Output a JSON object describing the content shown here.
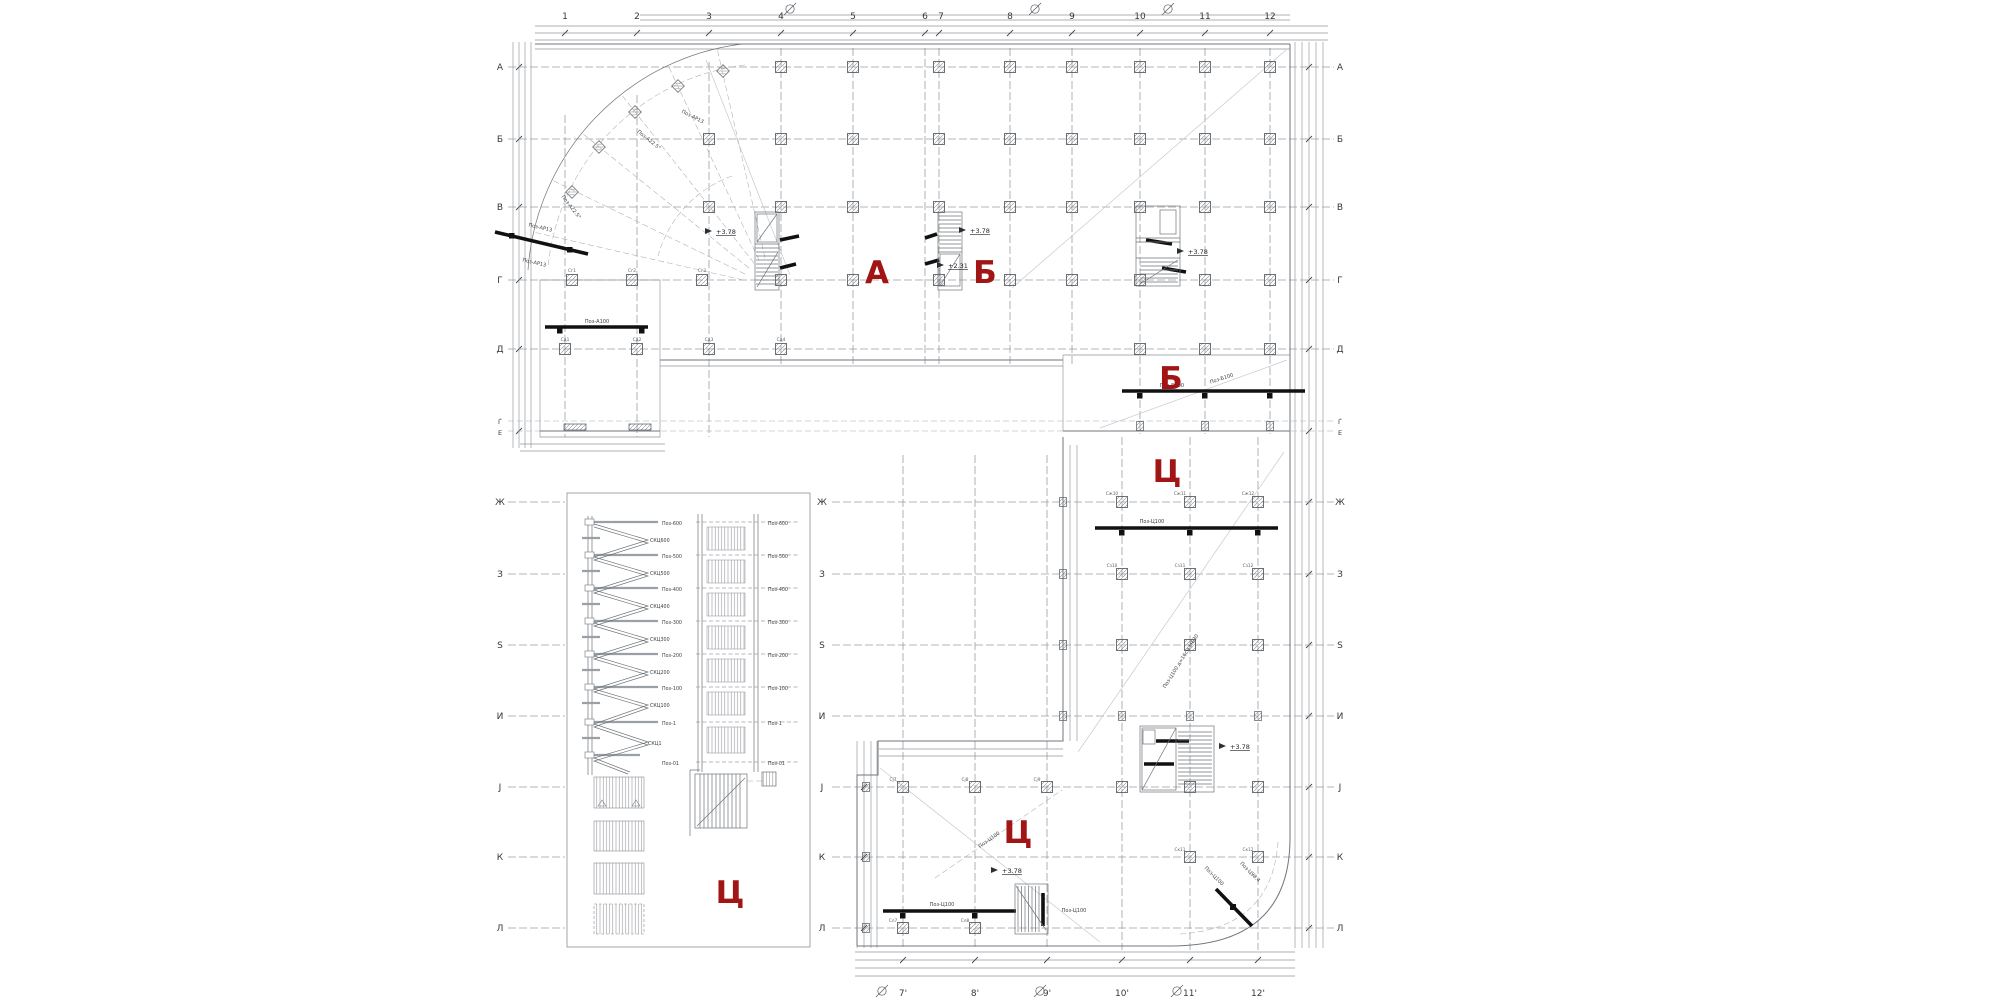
{
  "colors": {
    "accent": "#a21515",
    "grid": "#999ea3",
    "ink": "#33383d"
  },
  "axes": {
    "top_cols": [
      "1",
      "2",
      "3",
      "4",
      "5",
      "6",
      "7",
      "8",
      "9",
      "10",
      "11",
      "12"
    ],
    "bottom_cols": [
      "7'",
      "8'",
      "9'",
      "10'",
      "11'",
      "12'"
    ],
    "rows": [
      "А",
      "Б",
      "В",
      "Г",
      "Д",
      "Ѓ",
      "Е",
      "Ж",
      "З",
      "Ѕ",
      "И",
      "Ј",
      "К",
      "Л"
    ]
  },
  "sections": {
    "a": "А",
    "b": "Б",
    "b2": "Б",
    "c1": "Ц",
    "c2": "Ц",
    "c3": "Ц"
  },
  "levels": {
    "e378": "+3.78",
    "e231": "+2.31"
  },
  "beams": {
    "a100": "Поз-А100",
    "ar13": "Поз-АР13",
    "a225": "Поз-А22.5°",
    "b100": "Поз-Б100",
    "c100": "Поз-Ц100",
    "c984": "Поз-Ц98.4",
    "slab_note": "Поз-Ц100 д=16см МБ30"
  },
  "stairs": {
    "flights": [
      "Поз-600",
      "Поз-500",
      "Поз-400",
      "Поз-300",
      "Поз-200",
      "Поз-100",
      "Поз-1",
      "Поз-01"
    ],
    "landings": [
      "СКЦ600",
      "СКЦ500",
      "СКЦ400",
      "СКЦ300",
      "СКЦ200",
      "СКЦ100",
      "СКЦ1"
    ]
  },
  "tags": {
    "g1": "Сг1",
    "g2": "Сг2",
    "g3": "Сг3",
    "d1": "Сд1",
    "d2": "Сд2",
    "d3": "Сд3",
    "d4": "Сд4",
    "zh10": "Сж10",
    "zh11": "Сж11",
    "zh12": "Сж12",
    "z10": "Сз10",
    "z11": "Сз11",
    "z12": "Сз12",
    "j7": "Сј7",
    "j8": "Сј8",
    "j9": "Сј9",
    "k11": "Ск11",
    "k12": "Ск12",
    "l7": "Сл7",
    "l8": "Сл8"
  }
}
